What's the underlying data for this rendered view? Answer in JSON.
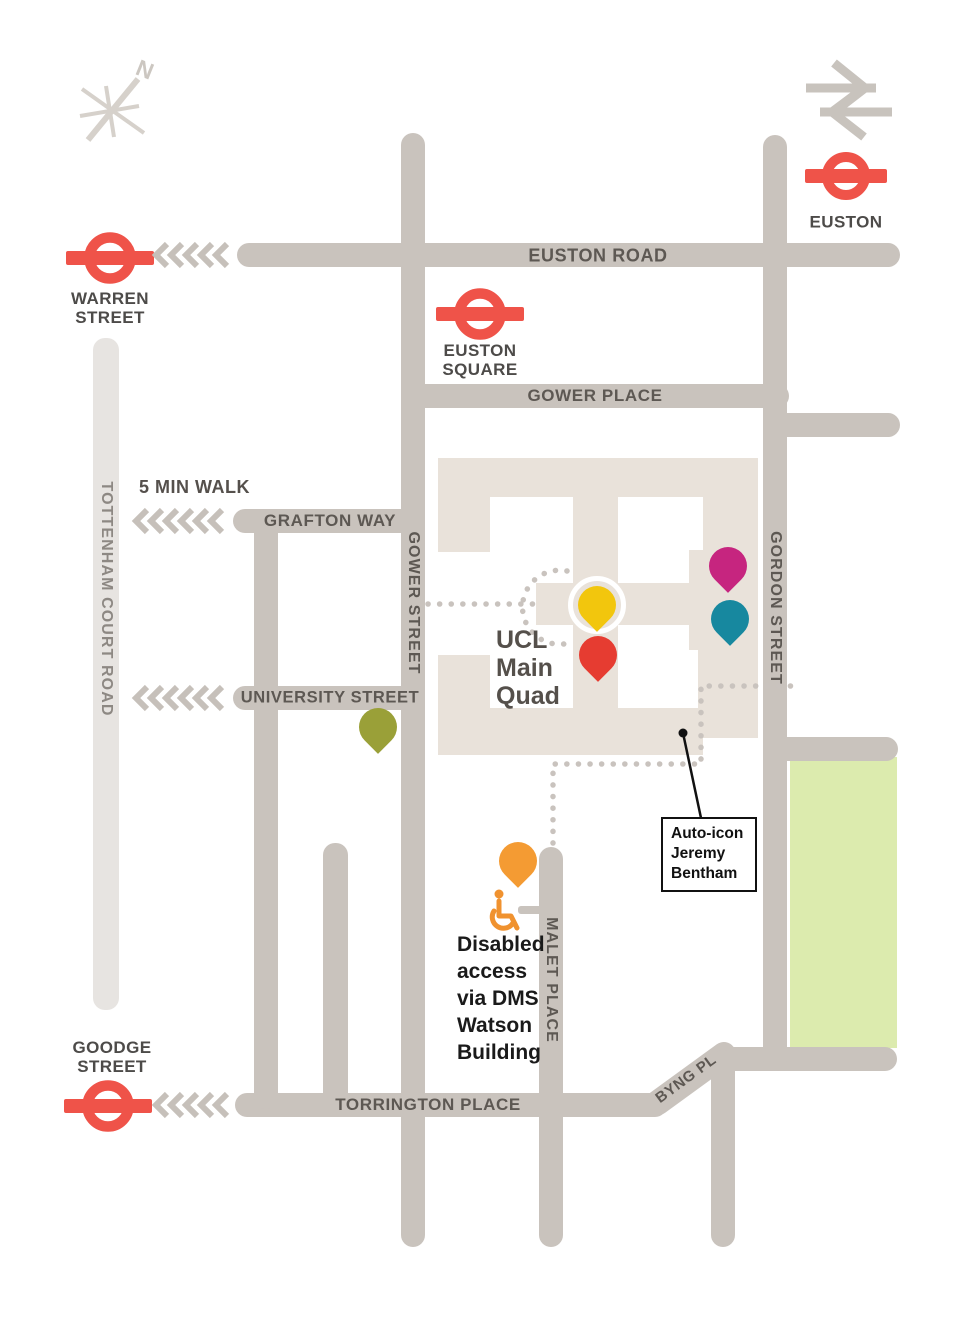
{
  "colors": {
    "street_gray": "#c9c3bd",
    "street_light_gray": "#e7e4e1",
    "building_beige": "#e9e2da",
    "green_space": "#dcebae",
    "roundel_red": "#ef5349",
    "street_label_gray": "#5d5853",
    "station_label_gray": "#4d4b49",
    "pin_yellow": "#f2c60d",
    "pin_red": "#e63c31",
    "pin_magenta": "#c6257f",
    "pin_teal": "#17889f",
    "pin_olive": "#9aa038",
    "pin_orange": "#f49b33",
    "disabled_access_orange": "#f0922f"
  },
  "compass": {
    "north_label": "N"
  },
  "stations": {
    "euston": {
      "name": "EUSTON"
    },
    "warren_street": {
      "line1": "WARREN",
      "line2": "STREET"
    },
    "euston_square": {
      "line1": "EUSTON",
      "line2": "SQUARE"
    },
    "goodge_street": {
      "line1": "GOODGE",
      "line2": "STREET"
    }
  },
  "streets": {
    "euston_road": "EUSTON ROAD",
    "gower_place": "GOWER PLACE",
    "grafton_way": "GRAFTON WAY",
    "university_street": "UNIVERSITY STREET",
    "gower_street": "GOWER STREET",
    "gordon_street": "GORDON STREET",
    "tottenham_court_road": "TOTTENHAM COURT ROAD",
    "malet_place": "MALET PLACE",
    "torrington_place": "TORRINGTON PLACE",
    "byng_pl": "BYNG PL"
  },
  "annotations": {
    "walk_time": "5 MIN WALK",
    "quad_line1": "UCL",
    "quad_line2": "Main",
    "quad_line3": "Quad",
    "auto_icon_line1": "Auto-icon",
    "auto_icon_line2": "Jeremy",
    "auto_icon_line3": "Bentham",
    "disabled_line1": "Disabled",
    "disabled_line2": "access",
    "disabled_line3": "via DMS",
    "disabled_line4": "Watson",
    "disabled_line5": "Building"
  }
}
